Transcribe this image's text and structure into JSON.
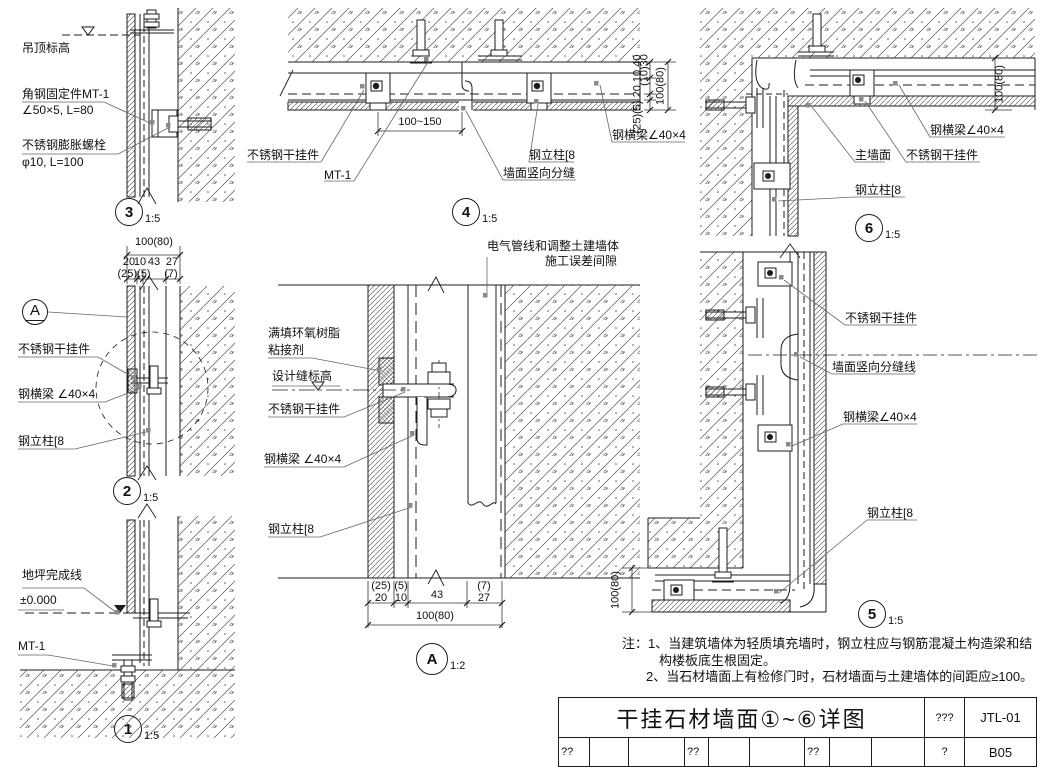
{
  "titleblock": {
    "title": "干挂石材墙面①~⑥详图",
    "field1": "???",
    "drawing_no": "JTL-01",
    "row2": [
      "??",
      "",
      "",
      "??",
      "",
      "",
      "??",
      "",
      "",
      "?",
      "B05"
    ]
  },
  "notes": {
    "line1": "注：1、当建筑墙体为轻质填充墙时，钢立柱应与钢筋混凝土构造梁和结",
    "line2": "构楼板底生根固定。",
    "line3": "2、当石材墙面上有检修门时，石材墙面与土建墙体的间距应≥100。"
  },
  "colors": {
    "line": "#1c1c1c",
    "leader_dot": "#8a8a8a",
    "background": "#ffffff"
  },
  "bubbles": [
    {
      "name": "detail-3-bubble",
      "number": "3",
      "scale": "1:5",
      "x": 129,
      "y": 212,
      "r": 14
    },
    {
      "name": "detail-4-bubble",
      "number": "4",
      "scale": "1:5",
      "x": 466,
      "y": 212,
      "r": 14
    },
    {
      "name": "detail-6-bubble",
      "number": "6",
      "scale": "1:5",
      "x": 869,
      "y": 228,
      "r": 14
    },
    {
      "name": "detail-2-bubble",
      "number": "2",
      "scale": "1:5",
      "x": 127,
      "y": 491,
      "r": 14
    },
    {
      "name": "detail-1-bubble",
      "number": "1",
      "scale": "1:5",
      "x": 128,
      "y": 729,
      "r": 14
    },
    {
      "name": "detail-5-bubble",
      "number": "5",
      "scale": "1:5",
      "x": 872,
      "y": 614,
      "r": 14
    },
    {
      "name": "detail-a-bubble",
      "number": "A",
      "scale": "1:2",
      "x": 432,
      "y": 659,
      "r": 16
    },
    {
      "name": "section-a-marker",
      "number": "A",
      "scale": "",
      "x": 35,
      "y": 312,
      "r": 13,
      "ul": true
    }
  ],
  "labels": [
    {
      "name": "d3-ceiling-level",
      "text": "吊顶标高",
      "x": 22,
      "y": 42
    },
    {
      "name": "d3-angle-bracket-1",
      "text": "角钢固定件MT-1",
      "x": 22,
      "y": 88
    },
    {
      "name": "d3-angle-bracket-2",
      "text": "∠50×5, L=80",
      "x": 22,
      "y": 104
    },
    {
      "name": "d3-expansion-bolt-1",
      "text": "不锈钢膨胀螺栓",
      "x": 22,
      "y": 139
    },
    {
      "name": "d3-expansion-bolt-2",
      "text": "φ10, L=100",
      "x": 22,
      "y": 156
    },
    {
      "name": "d4-dim-100-150",
      "text": "100~150",
      "x": 396,
      "y": 116,
      "cls": "c s",
      "w": 48
    },
    {
      "name": "d4-hanger",
      "text": "不锈钢干挂件",
      "x": 247,
      "y": 149
    },
    {
      "name": "d4-mt1",
      "text": "MT-1",
      "x": 324,
      "y": 169
    },
    {
      "name": "d4-column",
      "text": "钢立柱[8",
      "x": 529,
      "y": 149
    },
    {
      "name": "d4-joint",
      "text": "墙面竖向分缝",
      "x": 503,
      "y": 167
    },
    {
      "name": "d4-beam",
      "text": "钢横梁∠40×4",
      "x": 612,
      "y": 129
    },
    {
      "name": "d4-dim-v1",
      "text": "(10)30",
      "x": 645,
      "y": 70,
      "rot": true,
      "cls": "s"
    },
    {
      "name": "d4-dim-v2",
      "text": "(25)(5) 20 10 40",
      "x": 638,
      "y": 94,
      "rot": true,
      "cls": "s"
    },
    {
      "name": "d4-dim-v3",
      "text": "100(80)",
      "x": 661,
      "y": 86,
      "rot": true,
      "cls": "s"
    },
    {
      "name": "d6-dim-100-80",
      "text": "100(80)",
      "x": 1000,
      "y": 84,
      "rot": true,
      "cls": "s"
    },
    {
      "name": "d6-beam",
      "text": "钢横梁∠40×4",
      "x": 930,
      "y": 124
    },
    {
      "name": "d6-main-wall",
      "text": "主墙面",
      "x": 855,
      "y": 149
    },
    {
      "name": "d6-hanger",
      "text": "不锈钢干挂件",
      "x": 906,
      "y": 149
    },
    {
      "name": "d6-column",
      "text": "钢立柱[8",
      "x": 855,
      "y": 184
    },
    {
      "name": "d2-dim-total",
      "text": "100(80)",
      "x": 128,
      "y": 236,
      "cls": "c s",
      "w": 52
    },
    {
      "name": "d2-dim-20",
      "text": "20",
      "x": 122,
      "y": 256,
      "cls": "c s",
      "w": 14
    },
    {
      "name": "d2-dim-10",
      "text": "10",
      "x": 133,
      "y": 256,
      "cls": "c s",
      "w": 14
    },
    {
      "name": "d2-dim-43",
      "text": "43",
      "x": 146,
      "y": 256,
      "cls": "c s",
      "w": 16
    },
    {
      "name": "d2-dim-27",
      "text": "27",
      "x": 164,
      "y": 256,
      "cls": "c s",
      "w": 16
    },
    {
      "name": "d2-dim-25-5",
      "text": "(25)(5)",
      "x": 116,
      "y": 268,
      "cls": "c s",
      "w": 36
    },
    {
      "name": "d2-dim-7",
      "text": "(7)",
      "x": 162,
      "y": 268,
      "cls": "c s",
      "w": 18
    },
    {
      "name": "d2-hanger",
      "text": "不锈钢干挂件",
      "x": 18,
      "y": 343
    },
    {
      "name": "d2-beam",
      "text": "钢横梁 ∠40×4",
      "x": 18,
      "y": 388
    },
    {
      "name": "d2-column",
      "text": "钢立柱[8",
      "x": 18,
      "y": 435
    },
    {
      "name": "da-elec-1",
      "text": "电气管线和调整土建墙体",
      "x": 487,
      "y": 240
    },
    {
      "name": "da-elec-2",
      "text": "施工误差间隙",
      "x": 545,
      "y": 255
    },
    {
      "name": "da-epoxy-1",
      "text": "满填环氧树脂",
      "x": 268,
      "y": 327
    },
    {
      "name": "da-epoxy-2",
      "text": "粘接剂",
      "x": 268,
      "y": 344
    },
    {
      "name": "da-joint-level",
      "text": "设计缝标高",
      "x": 272,
      "y": 370
    },
    {
      "name": "da-hanger",
      "text": "不锈钢干挂件",
      "x": 268,
      "y": 403
    },
    {
      "name": "da-beam",
      "text": "钢横梁 ∠40×4",
      "x": 264,
      "y": 453
    },
    {
      "name": "da-column",
      "text": "钢立柱[8",
      "x": 268,
      "y": 523
    },
    {
      "name": "da-dim-25",
      "text": "(25)",
      "x": 368,
      "y": 580,
      "cls": "c s",
      "w": 26
    },
    {
      "name": "da-dim-5",
      "text": "(5)",
      "x": 391,
      "y": 580,
      "cls": "c s",
      "w": 20
    },
    {
      "name": "da-dim-7",
      "text": "(7)",
      "x": 472,
      "y": 580,
      "cls": "c s",
      "w": 24
    },
    {
      "name": "da-dim-20",
      "text": "20",
      "x": 368,
      "y": 592,
      "cls": "c s",
      "w": 26
    },
    {
      "name": "da-dim-10",
      "text": "10",
      "x": 391,
      "y": 592,
      "cls": "c s",
      "w": 20
    },
    {
      "name": "da-dim-43",
      "text": "43",
      "x": 424,
      "y": 589,
      "cls": "c s",
      "w": 26
    },
    {
      "name": "da-dim-27",
      "text": "27",
      "x": 472,
      "y": 592,
      "cls": "c s",
      "w": 24
    },
    {
      "name": "da-dim-total",
      "text": "100(80)",
      "x": 409,
      "y": 610,
      "cls": "c s",
      "w": 52
    },
    {
      "name": "d5-hanger",
      "text": "不锈钢干挂件",
      "x": 845,
      "y": 312
    },
    {
      "name": "d5-joint-line",
      "text": "墙面竖向分缝线",
      "x": 832,
      "y": 361
    },
    {
      "name": "d5-beam",
      "text": "钢横梁∠40×4",
      "x": 843,
      "y": 411
    },
    {
      "name": "d5-column",
      "text": "钢立柱[8",
      "x": 867,
      "y": 507
    },
    {
      "name": "d5-dim-100-80",
      "text": "100(80)",
      "x": 616,
      "y": 590,
      "rot": true,
      "cls": "s"
    },
    {
      "name": "d1-floor-line",
      "text": "地坪完成线",
      "x": 22,
      "y": 569
    },
    {
      "name": "d1-level",
      "text": "±0.000",
      "x": 20,
      "y": 594
    },
    {
      "name": "d1-mt1",
      "text": "MT-1",
      "x": 18,
      "y": 640
    }
  ]
}
